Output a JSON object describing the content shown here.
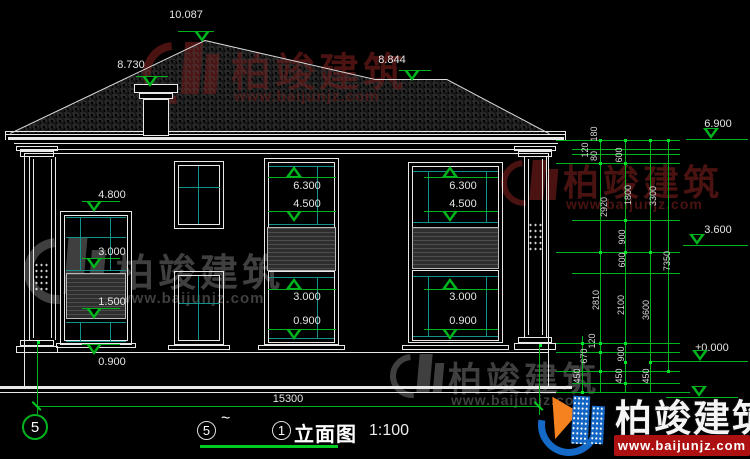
{
  "colors": {
    "background": "#000000",
    "line_white": "#e8e8e8",
    "dim_green": "#00b41e",
    "glass_cyan": "#13918c",
    "watermark_red": "#4a1311",
    "watermark_gray": "#3f3f3f",
    "logo_blue": "#1569c7",
    "logo_orange": "#f5821f",
    "banner_red": "#ac1010"
  },
  "watermark": {
    "brand": "柏竣建筑",
    "url": "www.baijunjz.com"
  },
  "badge": {
    "brand": "柏竣建筑",
    "url": "www.baijunjz.com"
  },
  "title_bar": {
    "axis_from": "5",
    "separator": "~",
    "axis_to": "1",
    "label": "立面图",
    "scale": "1:100"
  },
  "axis_bubble_left": "5",
  "overall_dim": "15300",
  "elevation_markers": [
    {
      "value": "10.087",
      "tx": 164,
      "ty": 9,
      "tw": 44,
      "line": [
        178,
        36,
        31
      ],
      "tri": [
        194,
        31,
        "down"
      ]
    },
    {
      "value": "8.730",
      "tx": 109,
      "ty": 59,
      "tw": 44,
      "line": [
        136,
        32,
        76
      ],
      "tri": [
        142,
        76,
        "down"
      ]
    },
    {
      "value": "8.844",
      "tx": 370,
      "ty": 54,
      "tw": 44,
      "line": [
        399,
        32,
        70
      ],
      "tri": [
        404,
        70,
        "down"
      ]
    },
    {
      "value": "6.900",
      "tx": 692,
      "ty": 118,
      "tw": 52,
      "line": [
        686,
        62,
        139
      ],
      "tri": [
        703,
        128,
        "down"
      ]
    },
    {
      "value": "3.600",
      "tx": 692,
      "ty": 224,
      "tw": 52,
      "line": [
        683,
        65,
        245
      ],
      "tri": [
        689,
        234,
        "down"
      ]
    },
    {
      "value": "±0.000",
      "tx": 684,
      "ty": 342,
      "tw": 56,
      "line": [
        652,
        96,
        361
      ],
      "tri": [
        692,
        350,
        "down"
      ]
    },
    {
      "value": "",
      "tx": 0,
      "ty": 0,
      "tw": 0,
      "line": [
        666,
        72,
        397
      ],
      "tri": [
        691,
        386,
        "down"
      ]
    },
    {
      "value": "4.800",
      "tx": 94,
      "ty": 189,
      "tw": 36,
      "line": [
        82,
        38,
        201
      ],
      "tri": [
        86,
        201,
        "down"
      ]
    },
    {
      "value": "3.000",
      "tx": 94,
      "ty": 246,
      "tw": 36,
      "line": [
        82,
        38,
        258
      ],
      "tri": [
        86,
        258,
        "down"
      ]
    },
    {
      "value": "1.500",
      "tx": 94,
      "ty": 296,
      "tw": 36,
      "line": [
        82,
        38,
        308
      ],
      "tri": [
        86,
        308,
        "down"
      ]
    },
    {
      "value": "0.900",
      "tx": 94,
      "ty": 356,
      "tw": 36,
      "line": [
        82,
        38,
        344
      ],
      "tri": [
        86,
        344,
        "down"
      ]
    },
    {
      "value": "6.300",
      "tx": 289,
      "ty": 180,
      "tw": 36,
      "line": [
        268,
        68,
        177
      ],
      "tri": [
        286,
        166,
        "up"
      ]
    },
    {
      "value": "4.500",
      "tx": 289,
      "ty": 198,
      "tw": 36,
      "line": [
        268,
        68,
        211
      ],
      "tri": [
        286,
        211,
        "down"
      ]
    },
    {
      "value": "3.000",
      "tx": 289,
      "ty": 291,
      "tw": 36,
      "line": [
        268,
        68,
        289
      ],
      "tri": [
        286,
        278,
        "up"
      ]
    },
    {
      "value": "0.900",
      "tx": 289,
      "ty": 315,
      "tw": 36,
      "line": [
        268,
        68,
        329
      ],
      "tri": [
        286,
        329,
        "down"
      ]
    },
    {
      "value": "6.300",
      "tx": 445,
      "ty": 180,
      "tw": 36,
      "line": [
        424,
        74,
        177
      ],
      "tri": [
        442,
        166,
        "up"
      ]
    },
    {
      "value": "4.500",
      "tx": 445,
      "ty": 198,
      "tw": 36,
      "line": [
        424,
        74,
        211
      ],
      "tri": [
        442,
        211,
        "down"
      ]
    },
    {
      "value": "3.000",
      "tx": 445,
      "ty": 291,
      "tw": 36,
      "line": [
        424,
        74,
        289
      ],
      "tri": [
        442,
        278,
        "up"
      ]
    },
    {
      "value": "0.900",
      "tx": 445,
      "ty": 315,
      "tw": 36,
      "line": [
        424,
        74,
        329
      ],
      "tri": [
        442,
        329,
        "down"
      ]
    }
  ],
  "right_dims": [
    {
      "v": "180",
      "x": 594,
      "y": 135
    },
    {
      "v": "120",
      "x": 585,
      "y": 151
    },
    {
      "v": "80",
      "x": 594,
      "y": 157
    },
    {
      "v": "600",
      "x": 619,
      "y": 156
    },
    {
      "v": "1800",
      "x": 628,
      "y": 196
    },
    {
      "v": "2920",
      "x": 604,
      "y": 208
    },
    {
      "v": "3300",
      "x": 653,
      "y": 197
    },
    {
      "v": "900",
      "x": 622,
      "y": 238
    },
    {
      "v": "600",
      "x": 622,
      "y": 261
    },
    {
      "v": "7350",
      "x": 667,
      "y": 262
    },
    {
      "v": "2810",
      "x": 596,
      "y": 301
    },
    {
      "v": "2100",
      "x": 621,
      "y": 306
    },
    {
      "v": "3600",
      "x": 646,
      "y": 311
    },
    {
      "v": "120",
      "x": 592,
      "y": 342
    },
    {
      "v": "670",
      "x": 584,
      "y": 357
    },
    {
      "v": "900",
      "x": 621,
      "y": 355
    },
    {
      "v": "450",
      "x": 577,
      "y": 377
    },
    {
      "v": "450",
      "x": 619,
      "y": 377
    },
    {
      "v": "450",
      "x": 646,
      "y": 377
    }
  ]
}
